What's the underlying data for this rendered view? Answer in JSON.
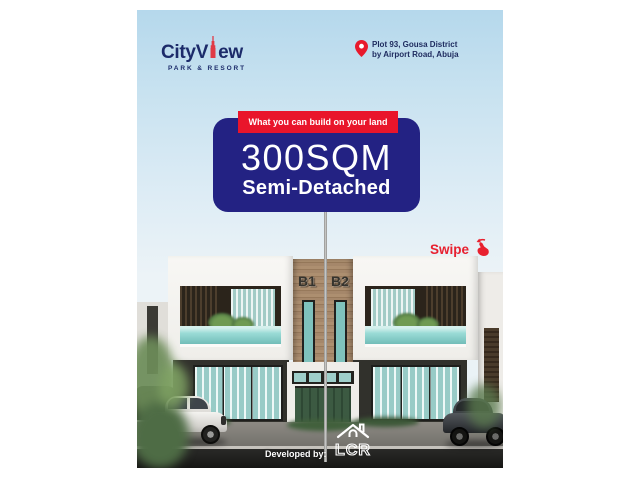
{
  "flyer": {
    "brand": {
      "name_prefix": "CityV",
      "name_suffix": "ew",
      "tagline": "PARK & RESORT"
    },
    "location": {
      "line1": "Plot 93, Gousa District",
      "line2": "by Airport Road, Abuja"
    },
    "offer_card": {
      "banner_label": "What you can build on your land",
      "plot_size": "300SQM",
      "house_type": "Semi-Detached"
    },
    "swipe_label": "Swipe",
    "building": {
      "unit_left_label": "B1",
      "unit_right_label": "B2"
    },
    "footer": {
      "developed_by_label": "Developed by:",
      "developer_name": "LCR"
    },
    "colors": {
      "card_navy": "#232283",
      "accent_red": "#E8192C",
      "brand_navy": "#1C2B6A",
      "sky_blue": "#BCDCEE",
      "glass_teal": "#8ED4D2",
      "wood_tan": "#A5876A"
    }
  }
}
